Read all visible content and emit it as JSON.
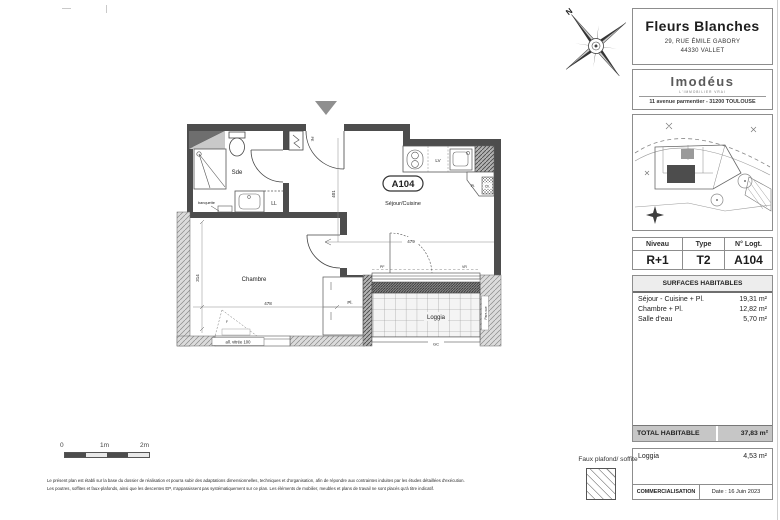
{
  "title_block": {
    "name": "Fleurs Blanches",
    "address1": "29, RUE ÉMILE GABORY",
    "address2": "44330 VALLET"
  },
  "agency_block": {
    "logo": "Imodéus",
    "tagline": "L'IMMOBILIER VRAI",
    "address": "11 avenue parmentier - 31200 TOULOUSE"
  },
  "unit_table": {
    "col1_header": "Niveau",
    "col2_header": "Type",
    "col3_header": "N° Logt.",
    "col1_value": "R+1",
    "col2_value": "T2",
    "col3_value": "A104"
  },
  "surfaces_table": {
    "title": "SURFACES HABITABLES",
    "rows": [
      {
        "label": "Séjour - Cuisine + Pl.",
        "value": "19,31 m²"
      },
      {
        "label": "Chambre + Pl.",
        "value": "12,82 m²"
      },
      {
        "label": "Salle d'eau",
        "value": "5,70 m²"
      }
    ],
    "total_label": "TOTAL HABITABLE",
    "total_value": "37,83 m²"
  },
  "annex_table": {
    "row_label": "Loggia",
    "row_value": "4,53 m²",
    "footer_left": "COMMERCIALISATION",
    "footer_right": "Date : 16 Juin 2023"
  },
  "floor_plan": {
    "badge": "A104",
    "room_sde": "Sde",
    "room_sejour": "Séjour/Cuisine",
    "room_chambre": "Chambre",
    "room_loggia": "Loggia",
    "label_ll": "LL",
    "label_lv": "LV",
    "label_banquette": "banquette",
    "label_pl_kitchen": "Pl.",
    "label_ch_kitchen": "Ch.",
    "label_pl_chambre": "Pl.",
    "label_pe": "PE",
    "label_pf": "PF",
    "label_vr": "VR",
    "label_gc": "GC",
    "label_parevue": "Pare-vue",
    "label_window": "all. vitrée 100",
    "label_f": "F",
    "dim_sejour_h": "401",
    "dim_chambre_h": "314",
    "dim_chambre_w": "478",
    "dim_sejour_w": "479",
    "compass_north": "N"
  },
  "scale_bar": {
    "tick0": "0",
    "tick1": "1m",
    "tick2": "2m"
  },
  "legend": {
    "faux_plafond": "Faux plafond/ soffite"
  },
  "footnotes": {
    "line1": "Le présent plan est établi sur la base du dossier de réalisation et pourra subir des adaptations dimensionnelles, techniques et d'organisation, afin de répondre aux contraintes induites par les études détaillées d'exécution.",
    "line2": "Les poutres, soffites et faux-plafonds, ainsi que les descentes EP, n'apparaissent pas systématiquement sur ce plan. Les éléments de mobilier, meubles et plans de travail ne sont placés qu'à titre indicatif."
  }
}
